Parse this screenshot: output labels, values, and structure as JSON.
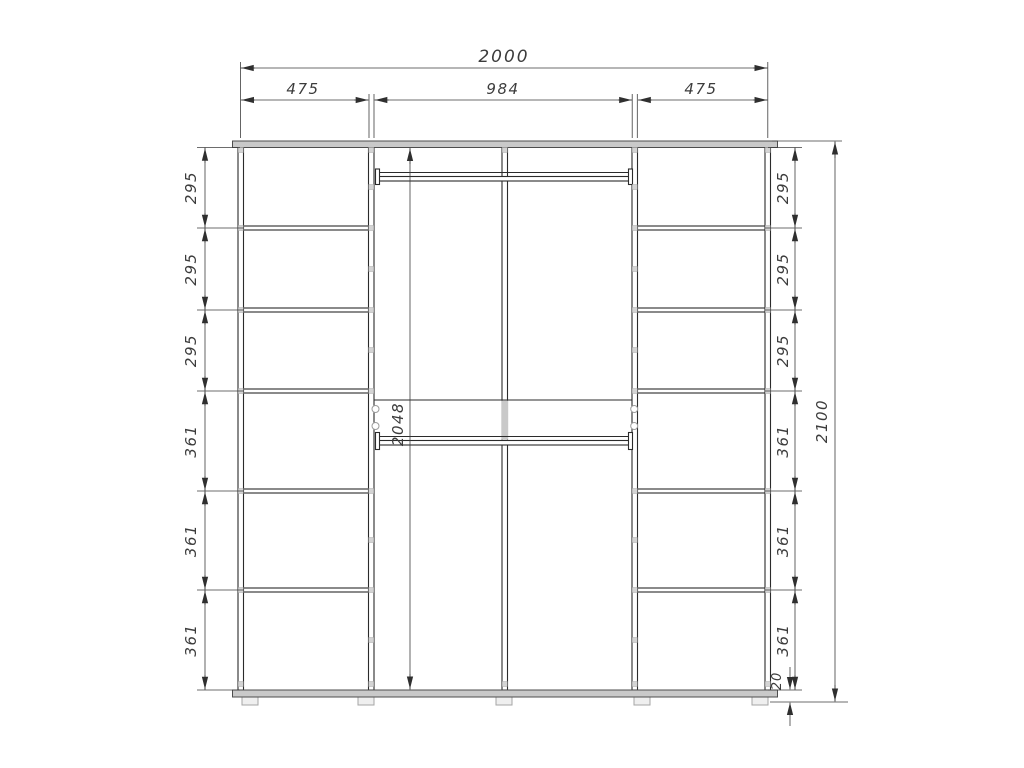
{
  "drawing": {
    "dims": {
      "total_width": "2000",
      "top_sections": [
        "475",
        "984",
        "475"
      ],
      "left_sections": [
        "295",
        "295",
        "295",
        "361",
        "361",
        "361"
      ],
      "right_sections": [
        "295",
        "295",
        "295",
        "361",
        "361",
        "361"
      ],
      "middle_height": "2048",
      "total_height": "2100",
      "base_height": "20"
    },
    "style": {
      "line_color": "#2b2b2b",
      "panel_fill": "#c9c9c9",
      "background": "#ffffff"
    }
  }
}
